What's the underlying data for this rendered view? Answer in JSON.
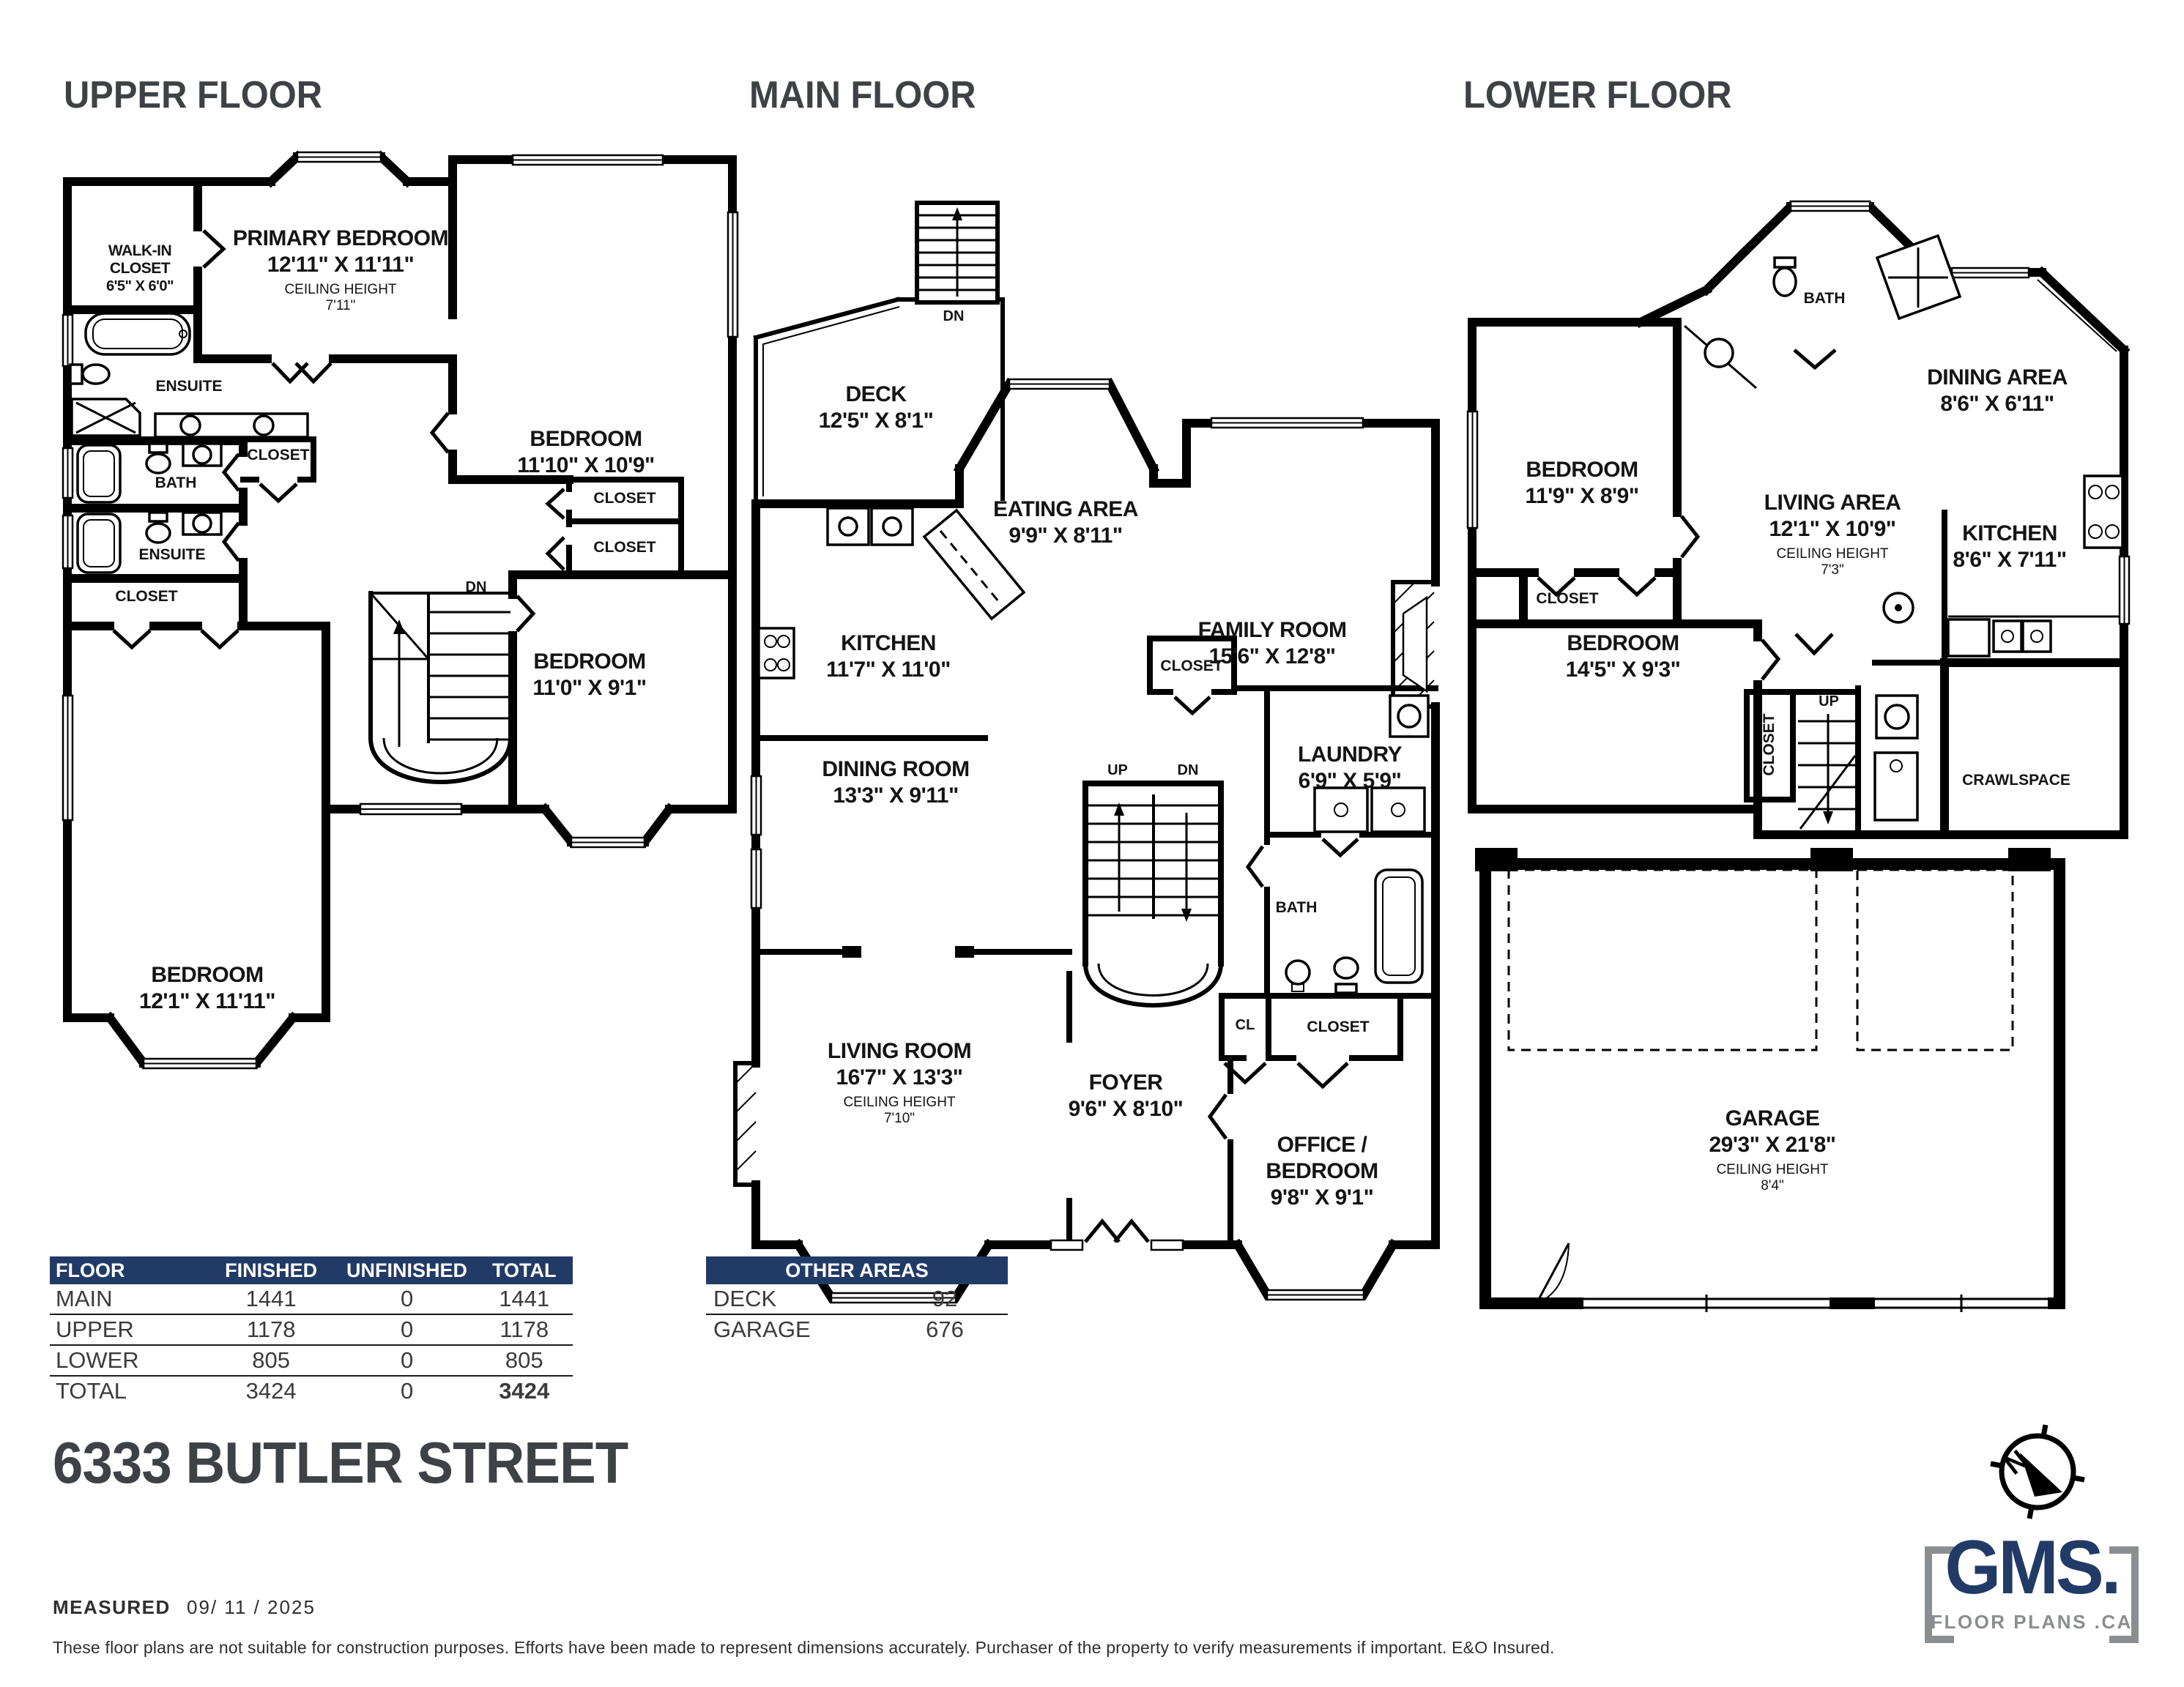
{
  "colors": {
    "navy": "#223a66",
    "title_gray": "#3e4145",
    "wall": "#000000",
    "logo_gray": "#8b8e91"
  },
  "floors": {
    "upper": {
      "title": "UPPER FLOOR",
      "rooms": {
        "walkin_name": "WALK-IN CLOSET",
        "walkin_dims": "6'5\" X 6'0\"",
        "primary_name": "PRIMARY BEDROOM",
        "primary_dims": "12'11\" X 11'11\"",
        "primary_ceiling_label": "CEILING HEIGHT",
        "primary_ceiling": "7'11\"",
        "bedroom2_name": "BEDROOM",
        "bedroom2_dims": "11'10\" X 10'9\"",
        "ensuite1": "ENSUITE",
        "closet_mid": "CLOSET",
        "bath": "BATH",
        "ensuite2": "ENSUITE",
        "closet_left": "CLOSET",
        "closet_r1": "CLOSET",
        "closet_r2": "CLOSET",
        "bedroom3_name": "BEDROOM",
        "bedroom3_dims": "11'0\" X 9'1\"",
        "bedroom4_name": "BEDROOM",
        "bedroom4_dims": "12'1\" X 11'11\"",
        "stairs_dn": "DN"
      }
    },
    "main": {
      "title": "MAIN FLOOR",
      "rooms": {
        "deck_name": "DECK",
        "deck_dims": "12'5\" X 8'1\"",
        "stairs_dn_top": "DN",
        "eating_name": "EATING AREA",
        "eating_dims": "9'9\" X 8'11\"",
        "kitchen_name": "KITCHEN",
        "kitchen_dims": "11'7\" X 11'0\"",
        "family_name": "FAMILY ROOM",
        "family_dims": "15'6\" X 12'8\"",
        "closet_top": "CLOSET",
        "laundry_name": "LAUNDRY",
        "laundry_dims": "6'9\" X 5'9\"",
        "bath": "BATH",
        "stairs_up": "UP",
        "stairs_dn": "DN",
        "dining_name": "DINING ROOM",
        "dining_dims": "13'3\" X 9'11\"",
        "living_name": "LIVING ROOM",
        "living_dims": "16'7\" X 13'3\"",
        "living_ceiling_label": "CEILING HEIGHT",
        "living_ceiling": "7'10\"",
        "foyer_name": "FOYER",
        "foyer_dims": "9'6\" X 8'10\"",
        "cl": "CL",
        "closet_foyer": "CLOSET",
        "office_name": "OFFICE / BEDROOM",
        "office_dims": "9'8\" X 9'1\""
      }
    },
    "lower": {
      "title": "LOWER FLOOR",
      "rooms": {
        "bath": "BATH",
        "bedroom1_name": "BEDROOM",
        "bedroom1_dims": "11'9\" X 8'9\"",
        "dining_name": "DINING AREA",
        "dining_dims": "8'6\" X 6'11\"",
        "living_name": "LIVING AREA",
        "living_dims": "12'1\" X 10'9\"",
        "living_ceiling_label": "CEILING HEIGHT",
        "living_ceiling": "7'3\"",
        "kitchen_name": "KITCHEN",
        "kitchen_dims": "8'6\" X 7'11\"",
        "closet1": "CLOSET",
        "closet2": "CLOSET",
        "bedroom2_name": "BEDROOM",
        "bedroom2_dims": "14'5\" X 9'3\"",
        "stairs_up": "UP",
        "crawlspace": "CRAWLSPACE",
        "garage_name": "GARAGE",
        "garage_dims": "29'3\" X 21'8\"",
        "garage_ceiling_label": "CEILING HEIGHT",
        "garage_ceiling": "8'4\""
      }
    }
  },
  "area_table": {
    "headers": [
      "FLOOR",
      "FINISHED",
      "UNFINISHED",
      "TOTAL"
    ],
    "rows": [
      {
        "floor": "MAIN",
        "finished": "1441",
        "unfinished": "0",
        "total": "1441"
      },
      {
        "floor": "UPPER",
        "finished": "1178",
        "unfinished": "0",
        "total": "1178"
      },
      {
        "floor": "LOWER",
        "finished": "805",
        "unfinished": "0",
        "total": "805"
      },
      {
        "floor": "TOTAL",
        "finished": "3424",
        "unfinished": "0",
        "total": "3424"
      }
    ]
  },
  "other_areas": {
    "header": "OTHER AREAS",
    "rows": [
      {
        "label": "DECK",
        "value": "92"
      },
      {
        "label": "GARAGE",
        "value": "676"
      }
    ]
  },
  "address": "6333 BUTLER STREET",
  "footer": {
    "measured_label": "MEASURED",
    "measured_date": "09/ 11 / 2025",
    "disclaimer": "These floor plans are not suitable for construction purposes. Efforts have been made to represent dimensions accurately.  Purchaser of the property to verify measurements if important.  E&O Insured."
  },
  "logo": {
    "text": "GMS.",
    "subtext": "FLOOR PLANS .CA"
  },
  "compass_letter": "N"
}
